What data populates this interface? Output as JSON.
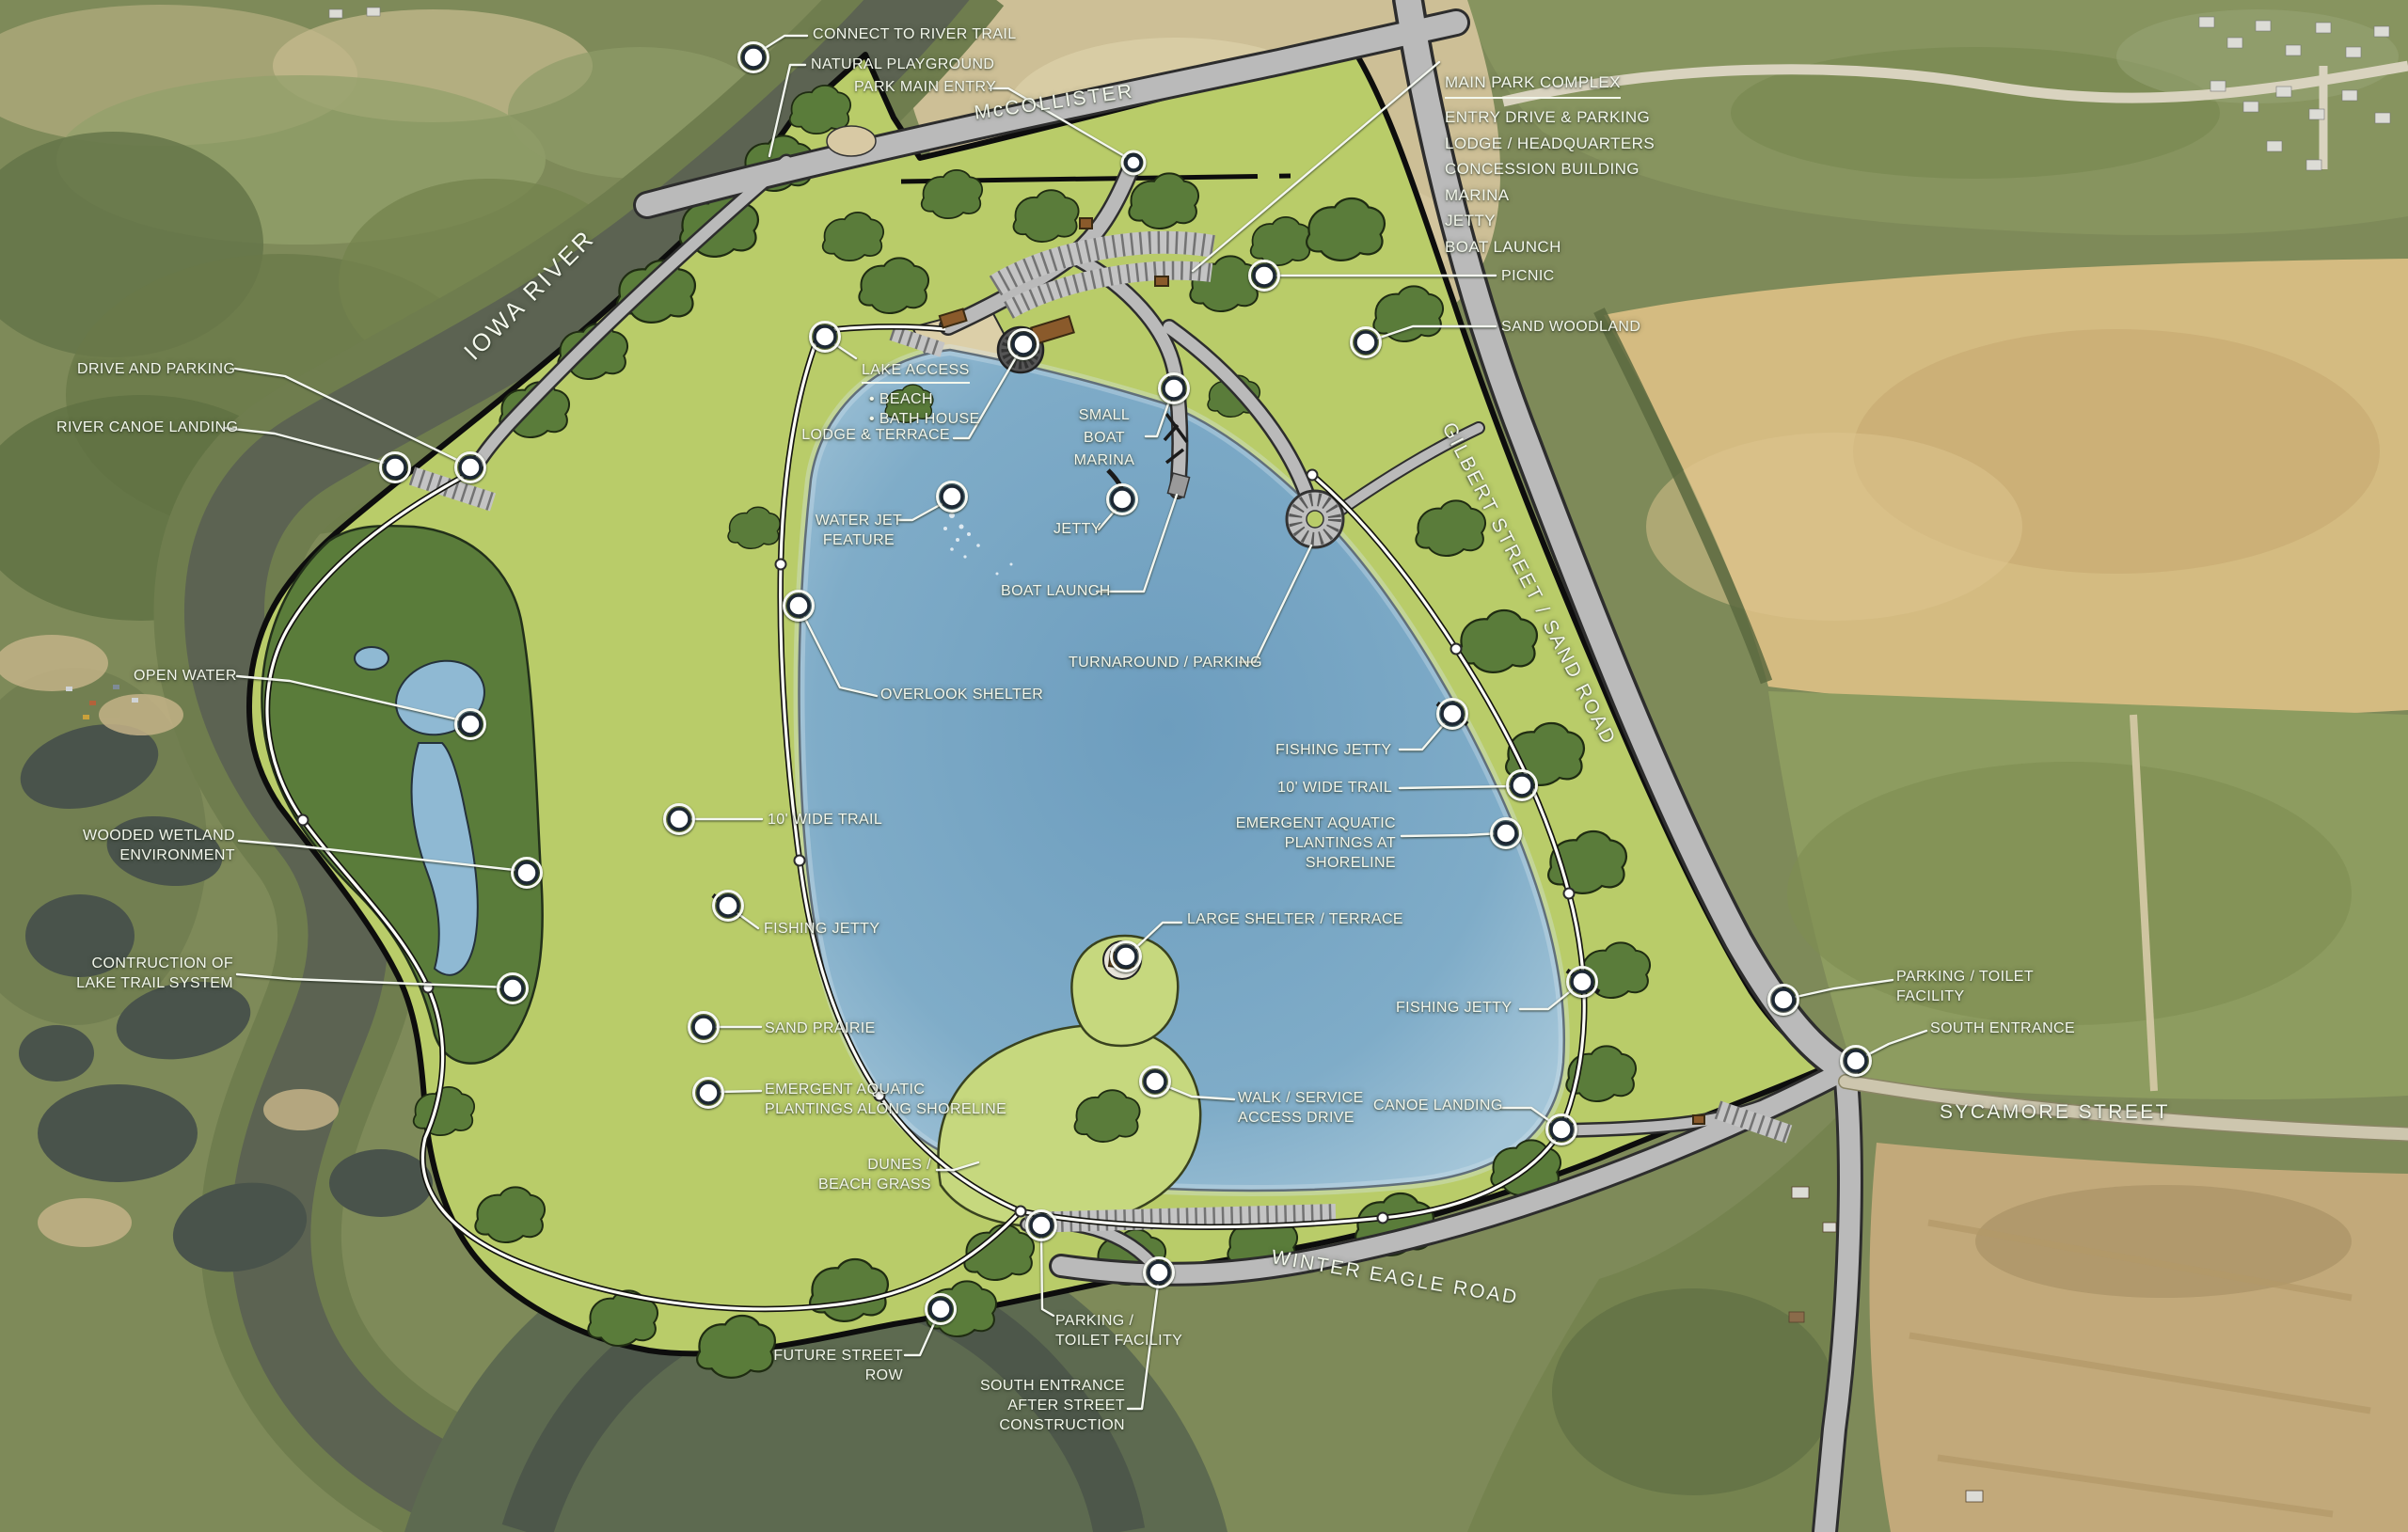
{
  "map": {
    "labels": {
      "connect_to_river_trail": "CONNECT TO RIVER TRAIL",
      "natural_playground": "NATURAL PLAYGROUND",
      "park_main_entry": "PARK MAIN ENTRY",
      "main_park_complex": {
        "title": "MAIN PARK COMPLEX",
        "items": "ENTRY DRIVE & PARKING\nLODGE / HEADQUARTERS\nCONCESSION BUILDING\nMARINA\nJETTY\nBOAT LAUNCH"
      },
      "picnic": "PICNIC",
      "sand_woodland": "SAND WOODLAND",
      "drive_and_parking": "DRIVE AND PARKING",
      "river_canoe_landing": "RIVER CANOE LANDING",
      "lake_access": {
        "title": "LAKE ACCESS",
        "items": "• BEACH\n• BATH HOUSE"
      },
      "lodge_terrace": "LODGE & TERRACE",
      "small_boat_marina": "SMALL\nBOAT\nMARINA",
      "water_jet_feature": "WATER JET\nFEATURE",
      "jetty": "JETTY",
      "boat_launch": "BOAT LAUNCH",
      "turnaround_parking": "TURNAROUND / PARKING",
      "open_water": "OPEN WATER",
      "overlook_shelter": "OVERLOOK SHELTER",
      "wooded_wetland": "WOODED WETLAND\nENVIRONMENT",
      "contruction_lake_trail": "CONTRUCTION OF\nLAKE TRAIL SYSTEM",
      "wide_trail_west": "10' WIDE TRAIL",
      "fishing_jetty_west": "FISHING JETTY",
      "sand_prairie": "SAND PRAIRIE",
      "emergent_west": "EMERGENT AQUATIC\nPLANTINGS ALONG SHORELINE",
      "dunes": "DUNES /\nBEACH GRASS",
      "large_shelter": "LARGE SHELTER / TERRACE",
      "walk_service": "WALK / SERVICE\nACCESS DRIVE",
      "canoe_landing": "CANOE LANDING",
      "fishing_jetty_ne": "FISHING JETTY",
      "wide_trail_east": "10' WIDE TRAIL",
      "emergent_east": "EMERGENT AQUATIC\nPLANTINGS AT SHORELINE",
      "fishing_jetty_se": "FISHING JETTY",
      "parking_toilet_east": "PARKING / TOILET\nFACILITY",
      "south_entrance": "SOUTH ENTRANCE",
      "parking_toilet_south": "PARKING /\nTOILET FACILITY",
      "south_entrance_after": "SOUTH ENTRANCE\nAFTER STREET\nCONSTRUCTION",
      "future_street_row": "FUTURE STREET ROW"
    },
    "road_labels": {
      "mccollister": "McCOLLISTER",
      "gilbert_street": "GILBERT STREET / SAND ROAD",
      "sycamore_street": "SYCAMORE STREET",
      "winter_eagle_road": "WINTER EAGLE ROAD",
      "iowa_river": "IOWA RIVER"
    },
    "icons": {
      "marker_dot": "○"
    },
    "colors": {
      "park_grass": "#b9cc69",
      "tree_green": "#5a7c3a",
      "lake_blue": "#7ba7c4",
      "road_gray": "#bababa",
      "sand": "#cdbf96",
      "boundary": "#0d0d0d",
      "label_text": "#f3f7ec"
    }
  }
}
